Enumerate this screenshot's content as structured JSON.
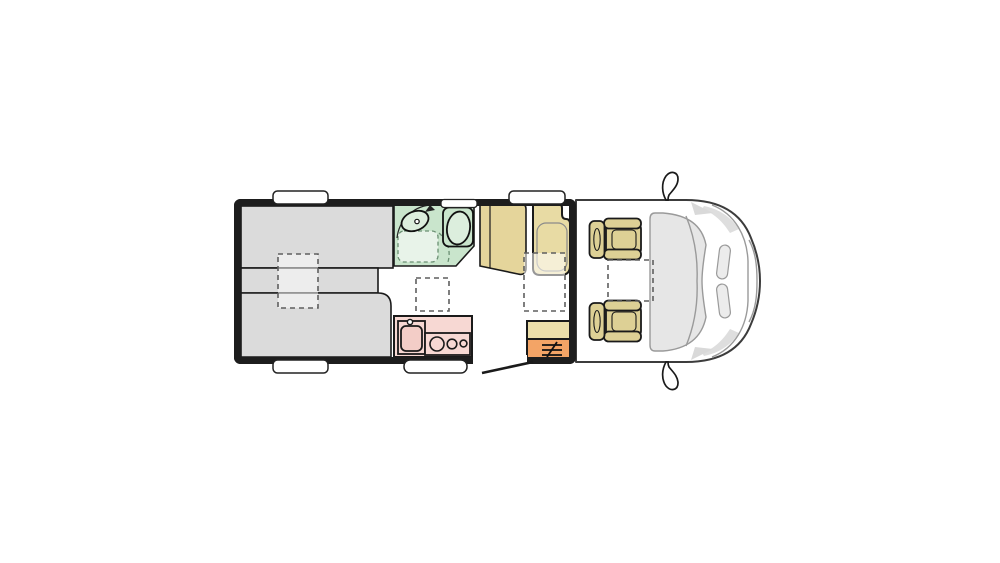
{
  "title": "Campervan floor plan (top view)",
  "colors": {
    "background": "#ffffff",
    "wall": "#1d1d1d",
    "outline": "#1a1a1a",
    "bed": "#dbdbdb",
    "bath": "#c9e5cc",
    "bath_light": "#e8f3e9",
    "fixture": "#dcEEdd",
    "wardrobe": "#e5d59b",
    "bench": "#e8dba4",
    "seat": "#ddd095",
    "kitchen": "#f7d8d3",
    "sink": "#f3cdc7",
    "cabinet": "#ecdfaa",
    "step": "#f3a466",
    "glass": "#e6e6e6",
    "shade": "#dcdcdc",
    "white": "#ffffff"
  },
  "labels": {
    "vehicle": "Campervan floor plan, top view",
    "habitation": "Habitation area walls",
    "rearBedUpper": "Rear bed - upper cushion",
    "rearBedMiddle": "Rear bed - middle cushion",
    "rearBedLower": "Rear bed - lower cushion",
    "bedExtension": "Bed extension (dashed option)",
    "bathroom": "Bathroom",
    "shower": "Shower (dashed)",
    "washbasin": "Washbasin",
    "toilet": "Toilet",
    "bathroomDoor": "Bathroom door swing",
    "bathroomWindow": "Bathroom window",
    "wardrobe": "Wardrobe",
    "travelSeat": "Travel seat bench",
    "table": "Table (dashed)",
    "roofVent": "Roof vent (dashed)",
    "kitchen": "Kitchen block",
    "kitchenSink": "Kitchen sink",
    "hob": "Hob with three burners",
    "entranceCabinet": "Entrance cabinet",
    "entranceStep": "Entrance step",
    "entranceDoor": "Entrance door opening",
    "doorSwing": "Open entrance door",
    "windowRearTop": "Window (rear, top wall)",
    "windowDinette": "Window (dinette, top wall)",
    "windowRearBottom": "Window (rear, bottom wall)",
    "exteriorStep": "Exterior entry step",
    "cab": "Driver cab",
    "windscreen": "Windscreen",
    "driverSeat": "Driver swivel seat",
    "passengerSeat": "Passenger swivel seat",
    "swivelZone": "Swivelled seat position (dashed)",
    "mirrorLeft": "Side mirror (upper)",
    "mirrorRight": "Side mirror (lower)",
    "headlights": "Headlights"
  }
}
